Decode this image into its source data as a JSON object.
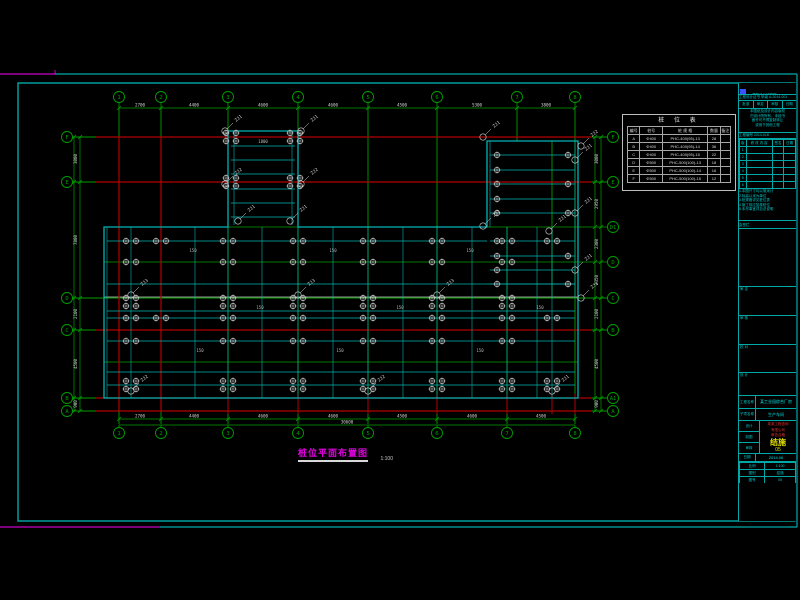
{
  "colors": {
    "green": "#00a000",
    "red": "#b40000",
    "cyan": "#00b4b4",
    "frame": "#00a8a8",
    "white": "#d2d2d2",
    "magenta": "#c800c8",
    "yellow": "#e0e000",
    "gray": "#969696",
    "blue": "#3c50ff"
  },
  "drawing_title": {
    "text": "桩位平面布置图",
    "scale": "1:100"
  },
  "pile_table": {
    "title": "桩 位 表",
    "headers": [
      "编号",
      "桩号",
      "桩 规 格",
      "数量",
      "备注"
    ],
    "col_w": [
      "12%",
      "22%",
      "44%",
      "12%",
      "10%"
    ],
    "rows": [
      [
        "A",
        "Φ400",
        "PHC-400(95)-13",
        "28",
        ""
      ],
      [
        "B",
        "Φ400",
        "PHC-400(95)-14",
        "36",
        ""
      ],
      [
        "C",
        "Φ400",
        "PHC-400(95)-15",
        "22",
        ""
      ],
      [
        "D",
        "Φ500",
        "PHC-500(100)-13",
        "18",
        ""
      ],
      [
        "E",
        "Φ500",
        "PHC-500(100)-14",
        "16",
        ""
      ],
      [
        "F",
        "Φ500",
        "PHC-500(100)-15",
        "12",
        ""
      ]
    ]
  },
  "title_block": {
    "company": "××建筑设计研究院",
    "cert": "工程设计证书 甲级 A-2014-001",
    "approve_cells": [
      "批准",
      "审定",
      "审核",
      "日期"
    ],
    "statement": [
      "本图纸及设计内容版权",
      "归设计院所有，未经书",
      "面许可不得复制转让",
      "或用于其他工程"
    ],
    "proj_no": "工程编号 2014-018",
    "rev": {
      "headers": [
        "版",
        "修 改 内 容",
        "签名",
        "日期"
      ],
      "rows": [
        [
          "1",
          "",
          "",
          ""
        ],
        [
          "2",
          "",
          "",
          ""
        ],
        [
          "3",
          "",
          "",
          ""
        ],
        [
          "4",
          "",
          "",
          ""
        ],
        [
          "5",
          "",
          "",
          ""
        ],
        [
          "6",
          "",
          "",
          ""
        ]
      ]
    },
    "notes": [
      "1.本图尺寸均以毫米计",
      "2.标高以米为单位",
      "3.桩规格详见桩位表",
      "4.施工前应复核桩位",
      "5.未尽事宜详见总说明"
    ],
    "huiqian": "会签栏",
    "roles": [
      "审 定",
      "审 核",
      "校 对",
      "设 计"
    ],
    "project_label": "工程名称",
    "project_value": "某工业园综合厂房",
    "sub_label": "子项名称",
    "sub_value": "生产车间",
    "staff": [
      "设计",
      "制图",
      "审核"
    ],
    "stamp_lines": [
      "某某工程咨询",
      "有限公司",
      "审查合格"
    ],
    "discipline": "结施",
    "sheet_no": "05",
    "date_label": "日期",
    "date_value": "2014.06",
    "bottom": [
      [
        "比例",
        "1:100"
      ],
      [
        "图别",
        "结施"
      ],
      [
        "图号",
        "05"
      ]
    ]
  },
  "plan": {
    "frame": {
      "outer_top_y": 74,
      "outer_bottom_y": 527,
      "outer_right_x": 797,
      "magenta_top_end_x": 55,
      "magenta_bottom_end_x": 160,
      "inner": [
        18,
        83,
        777,
        438
      ],
      "title_strip_x": 738
    },
    "green_v": [
      [
        119,
        108,
        424
      ],
      [
        161,
        108,
        424
      ],
      [
        228,
        108,
        424
      ],
      [
        298,
        108,
        424
      ],
      [
        368,
        108,
        424
      ],
      [
        437,
        108,
        424
      ],
      [
        507,
        227,
        424
      ],
      [
        517,
        108,
        141
      ],
      [
        552,
        141,
        298
      ],
      [
        575,
        108,
        424
      ]
    ],
    "green_h_major": [
      [
        137,
        72,
        607
      ],
      [
        182,
        72,
        607
      ],
      [
        298,
        72,
        607
      ],
      [
        330,
        72,
        607
      ],
      [
        398,
        72,
        607
      ],
      [
        411,
        72,
        607
      ]
    ],
    "green_h_minor": [
      [
        227,
        104,
        607
      ],
      [
        262,
        104,
        607
      ],
      [
        362,
        104,
        578
      ]
    ],
    "red_h": [
      [
        137,
        96,
        592
      ],
      [
        182,
        96,
        592
      ],
      [
        330,
        96,
        592
      ],
      [
        398,
        96,
        592
      ],
      [
        411,
        96,
        592
      ]
    ],
    "red_v": [
      [
        119,
        137,
        411
      ],
      [
        161,
        137,
        411
      ]
    ],
    "red_stub_v": [
      [
        228,
        394,
        414
      ],
      [
        298,
        394,
        414
      ],
      [
        368,
        394,
        414
      ],
      [
        437,
        394,
        414
      ],
      [
        507,
        394,
        414
      ],
      [
        552,
        394,
        414
      ],
      [
        575,
        394,
        414
      ]
    ],
    "gray_h": [
      [
        297,
        104,
        578
      ]
    ],
    "outline": "M104,227 L228,227 L228,131 L298,131 L298,227 L487,227 L487,141 L578,141 L578,398 L104,398 Z",
    "cyan_h": [
      [
        146,
        231,
        295
      ],
      [
        160,
        231,
        295
      ],
      [
        174,
        231,
        295
      ],
      [
        189,
        231,
        295
      ],
      [
        203,
        231,
        295
      ],
      [
        217,
        231,
        295
      ],
      [
        155,
        490,
        575
      ],
      [
        170,
        490,
        575
      ],
      [
        184,
        490,
        575
      ],
      [
        199,
        490,
        575
      ],
      [
        213,
        490,
        575
      ],
      [
        241,
        490,
        575
      ],
      [
        256,
        490,
        575
      ],
      [
        270,
        490,
        575
      ],
      [
        284,
        490,
        575
      ],
      [
        241,
        107,
        487
      ],
      [
        284,
        107,
        575
      ],
      [
        311,
        107,
        575
      ],
      [
        318,
        107,
        575
      ],
      [
        341,
        107,
        575
      ],
      [
        372,
        107,
        575
      ],
      [
        385,
        107,
        575
      ]
    ],
    "cyan_v": [
      [
        107,
        227,
        398
      ],
      [
        131,
        227,
        398
      ],
      [
        195,
        227,
        398
      ],
      [
        262,
        227,
        398
      ],
      [
        333,
        227,
        398
      ],
      [
        403,
        227,
        398
      ],
      [
        472,
        227,
        398
      ],
      [
        537,
        227,
        398
      ],
      [
        228,
        227,
        398
      ],
      [
        298,
        227,
        398
      ],
      [
        368,
        227,
        398
      ],
      [
        437,
        227,
        398
      ],
      [
        507,
        227,
        398
      ],
      [
        552,
        227,
        398
      ],
      [
        490,
        141,
        227
      ],
      [
        575,
        141,
        298
      ],
      [
        234,
        131,
        225
      ],
      [
        292,
        131,
        225
      ]
    ],
    "bubbles": {
      "r": 5.5,
      "top": {
        "y": 97,
        "items": [
          [
            119,
            "1"
          ],
          [
            161,
            "2"
          ],
          [
            228,
            "3"
          ],
          [
            298,
            "4"
          ],
          [
            368,
            "5"
          ],
          [
            437,
            "6"
          ],
          [
            517,
            "7"
          ],
          [
            575,
            "8"
          ]
        ]
      },
      "bottom": {
        "y": 433,
        "items": [
          [
            119,
            "1"
          ],
          [
            161,
            "2"
          ],
          [
            228,
            "3"
          ],
          [
            298,
            "4"
          ],
          [
            368,
            "5"
          ],
          [
            437,
            "6"
          ],
          [
            507,
            "7"
          ],
          [
            575,
            "8"
          ]
        ]
      },
      "left": {
        "x": 67,
        "items": [
          [
            137,
            "F"
          ],
          [
            182,
            "E"
          ],
          [
            298,
            "D"
          ],
          [
            330,
            "C"
          ],
          [
            398,
            "B"
          ],
          [
            411,
            "A"
          ]
        ]
      },
      "right": {
        "x": 613,
        "items": [
          [
            137,
            "F"
          ],
          [
            182,
            "E"
          ],
          [
            227,
            "D1"
          ],
          [
            262,
            "D"
          ],
          [
            298,
            "C"
          ],
          [
            330,
            "B"
          ],
          [
            398,
            "A1"
          ],
          [
            411,
            "A"
          ]
        ]
      }
    },
    "dims": {
      "top": {
        "y": 108,
        "x1": 119,
        "x2": 575,
        "ticks": [
          119,
          161,
          228,
          298,
          368,
          437,
          517,
          575
        ],
        "texts": [
          [
            140,
            "2700"
          ],
          [
            194,
            "4400"
          ],
          [
            263,
            "4600"
          ],
          [
            333,
            "4600"
          ],
          [
            402,
            "4500"
          ],
          [
            477,
            "5300"
          ],
          [
            546,
            "3800"
          ]
        ]
      },
      "bottom1": {
        "y": 419,
        "x1": 119,
        "x2": 575,
        "ticks": [
          119,
          161,
          228,
          298,
          368,
          437,
          507,
          575
        ],
        "texts": [
          [
            140,
            "2700"
          ],
          [
            194,
            "4400"
          ],
          [
            263,
            "4600"
          ],
          [
            333,
            "4600"
          ],
          [
            402,
            "4500"
          ],
          [
            472,
            "4600"
          ],
          [
            541,
            "4500"
          ]
        ]
      },
      "bottom2": {
        "y": 425,
        "x1": 119,
        "x2": 575,
        "texts": [
          [
            347,
            "30600"
          ]
        ]
      },
      "left": {
        "x1": 74,
        "x2": 80,
        "y1": 137,
        "y2": 411,
        "ticks": [
          137,
          182,
          298,
          330,
          398,
          411
        ],
        "texts": [
          [
            159,
            "3000"
          ],
          [
            240,
            "7800"
          ],
          [
            314,
            "2100"
          ],
          [
            364,
            "4500"
          ],
          [
            404,
            "900"
          ]
        ]
      },
      "right": {
        "x1": 595,
        "x2": 601,
        "y1": 137,
        "y2": 411,
        "ticks": [
          137,
          182,
          227,
          262,
          298,
          330,
          398,
          411
        ],
        "texts": [
          [
            159,
            "3000"
          ],
          [
            204,
            "2950"
          ],
          [
            244,
            "2300"
          ],
          [
            280,
            "2350"
          ],
          [
            314,
            "2100"
          ],
          [
            364,
            "4500"
          ],
          [
            404,
            "900"
          ]
        ]
      }
    },
    "piles": [
      {
        "type": "pair",
        "rows": [
          241,
          318
        ],
        "cols": [
          131,
          161,
          228,
          298,
          368,
          437,
          507,
          552
        ]
      },
      {
        "type": "pair",
        "rows": [
          262,
          341
        ],
        "cols": [
          131,
          228,
          298,
          368,
          437,
          507
        ]
      },
      {
        "type": "quad",
        "rows": [
          302
        ],
        "cols": [
          131,
          228,
          298,
          368,
          437,
          507
        ]
      },
      {
        "type": "quad",
        "rows": [
          385
        ],
        "cols": [
          131,
          228,
          298,
          368,
          437,
          507,
          552
        ]
      },
      {
        "type": "quad",
        "rows": [
          137,
          182
        ],
        "cols": [
          231,
          295
        ]
      },
      {
        "type": "single",
        "rows": [
          155,
          170,
          184,
          199,
          213,
          241,
          256,
          270,
          284
        ],
        "cols": [
          497
        ]
      },
      {
        "type": "single",
        "rows": [
          155,
          184,
          213,
          256,
          284
        ],
        "cols": [
          568
        ]
      }
    ],
    "tags": [
      [
        225,
        131,
        "ZJ1"
      ],
      [
        301,
        131,
        "ZJ1"
      ],
      [
        225,
        184,
        "ZJ2"
      ],
      [
        301,
        184,
        "ZJ2"
      ],
      [
        238,
        221,
        "ZJ1"
      ],
      [
        290,
        221,
        "ZJ1"
      ],
      [
        483,
        137,
        "ZJ1"
      ],
      [
        581,
        146,
        "ZJ2"
      ],
      [
        483,
        226,
        "ZJ2"
      ],
      [
        549,
        231,
        "ZJ1"
      ],
      [
        581,
        298,
        "ZJ2"
      ],
      [
        131,
        295,
        "ZJ3"
      ],
      [
        298,
        295,
        "ZJ3"
      ],
      [
        437,
        295,
        "ZJ3"
      ],
      [
        131,
        391,
        "ZJ2"
      ],
      [
        368,
        391,
        "ZJ2"
      ],
      [
        552,
        391,
        "ZJ1"
      ],
      [
        575,
        160,
        "ZJ1"
      ],
      [
        575,
        213,
        "ZJ1"
      ],
      [
        575,
        270,
        "ZJ1"
      ]
    ],
    "notes": [
      [
        263,
        143,
        "1800"
      ],
      [
        193,
        252,
        "150"
      ],
      [
        333,
        252,
        "150"
      ],
      [
        470,
        252,
        "150"
      ],
      [
        260,
        309,
        "150"
      ],
      [
        400,
        309,
        "150"
      ],
      [
        540,
        309,
        "150"
      ],
      [
        200,
        352,
        "150"
      ],
      [
        340,
        352,
        "150"
      ],
      [
        480,
        352,
        "150"
      ]
    ]
  }
}
